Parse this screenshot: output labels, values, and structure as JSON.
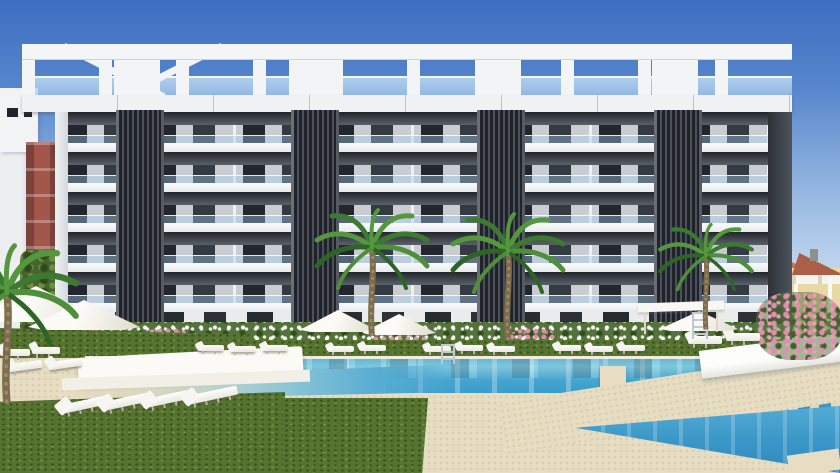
{
  "scene": {
    "description": "3D architectural rendering: modern six-storey white apartment residence with dark louvered accent towers and a rooftop pergola, fronted by palm trees, flowering hedges, lawns with sun loungers and parasols, and a large turquoise swimming-pool complex with geometric sand walkways",
    "building": {
      "storeys": 6,
      "accent_towers": 4,
      "rooftop_pergola": true,
      "facade_style": "white slabs with glass balconies"
    },
    "pool": {
      "sections": 3,
      "ladders": 2,
      "steps": "submerged comb steps",
      "water_color_name": "turquoise"
    },
    "vegetation": {
      "palm_trees": 4,
      "hedge": "white flowering hedge",
      "accent_flowers": "pink oleander"
    },
    "furniture": {
      "sun_loungers": 18,
      "parasols": 5,
      "gazebos": 1,
      "canopy_daybeds": 1
    },
    "background": {
      "left": "red brick apartment block and trees",
      "right": "yellow townhouses with terracotta roofs"
    }
  },
  "palette": {
    "sky-top": "#3e6ec0",
    "sky-mid": "#8fb1de",
    "sky-horizon": "#eef4fb",
    "facade-white": "#f2f3f5",
    "facade-gray": "#c9cdd2",
    "glass-dark": "#23272d",
    "louver-dark": "#20242a",
    "louver-light": "#4a515a",
    "water-light": "#7fccdf",
    "water-mid": "#44a5d0",
    "water-deep": "#2f88bc",
    "sand": "#e6ddc2",
    "grass": "#567430",
    "hedge-green": "#55713c",
    "flower-pink": "#df8fab",
    "terracotta": "#b5684c",
    "townhouse-yellow": "#e8d8a3",
    "brick-red": "#a3564c"
  }
}
